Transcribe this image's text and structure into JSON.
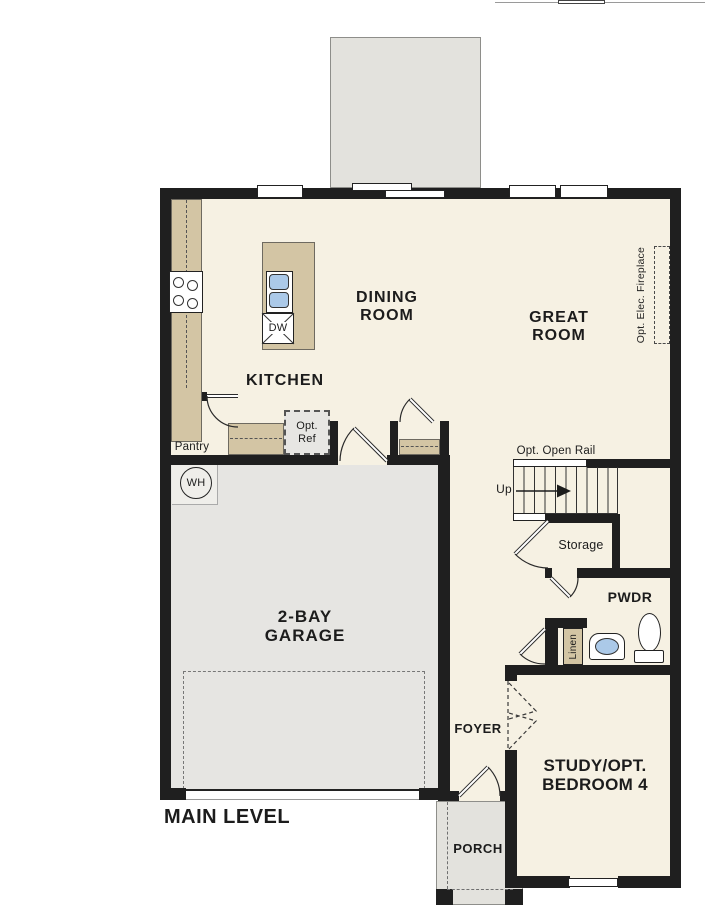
{
  "floor_plan": {
    "title": "MAIN LEVEL",
    "rooms": {
      "kitchen": {
        "label": "KITCHEN"
      },
      "dining": {
        "line1": "DINING",
        "line2": "ROOM"
      },
      "great": {
        "line1": "GREAT",
        "line2": "ROOM"
      },
      "garage": {
        "line1": "2-BAY",
        "line2": "GARAGE"
      },
      "foyer": {
        "label": "FOYER"
      },
      "porch": {
        "label": "PORCH"
      },
      "study": {
        "line1": "STUDY/OPT.",
        "line2": "BEDROOM 4"
      },
      "pwdr": {
        "label": "PWDR"
      },
      "storage": {
        "label": "Storage"
      },
      "pantry": {
        "label": "Pantry"
      },
      "linen": {
        "label": "Linen"
      }
    },
    "annotations": {
      "opt_open_rail": "Opt. Open Rail",
      "up": "Up",
      "opt_ref_line1": "Opt.",
      "opt_ref_line2": "Ref",
      "opt_elec_fireplace": "Opt. Elec. Fireplace",
      "water_heater": "WH",
      "dishwasher": "DW"
    },
    "colors": {
      "wall": "#1f1f1f",
      "floor": "#f6f1e3",
      "counter": "#d3c5a4",
      "concrete": "#e3e2dd",
      "garage_floor": "#e6e5e2",
      "fixture_blue": "#abc9e8",
      "optional_fill": "#e7e6e3"
    }
  }
}
